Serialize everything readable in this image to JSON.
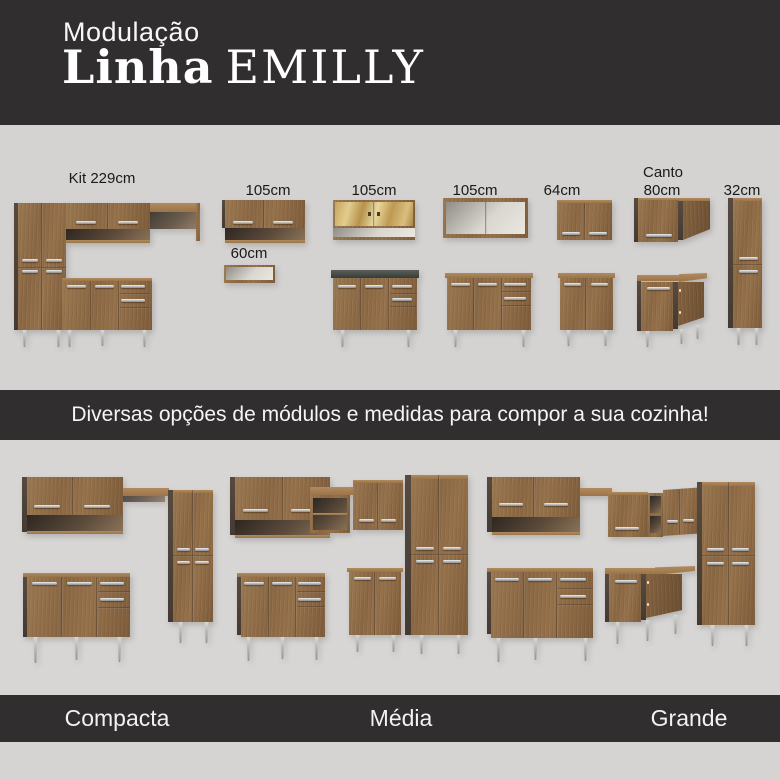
{
  "header": {
    "kicker": "Modulação",
    "title_bold": "Linha",
    "title_light": "EMILLY"
  },
  "module_labels": {
    "kit": "Kit 229cm",
    "a105_1": "105cm",
    "s60": "60cm",
    "a105_2": "105cm",
    "a105_3": "105cm",
    "a64": "64cm",
    "canto_line1": "Canto",
    "canto_line2": "80cm",
    "t32": "32cm"
  },
  "banner": {
    "text": "Diversas opções de módulos e medidas para compor a sua cozinha!"
  },
  "kitchen_sizes": {
    "compacta": "Compacta",
    "media": "Média",
    "grande": "Grande"
  },
  "colors": {
    "band_dark": "#302e2e",
    "background_gray": "#d4d3d2",
    "wood_brown": "#8f6b45",
    "dark_side_panel": "#544940",
    "counter_dark": "#474c47"
  }
}
